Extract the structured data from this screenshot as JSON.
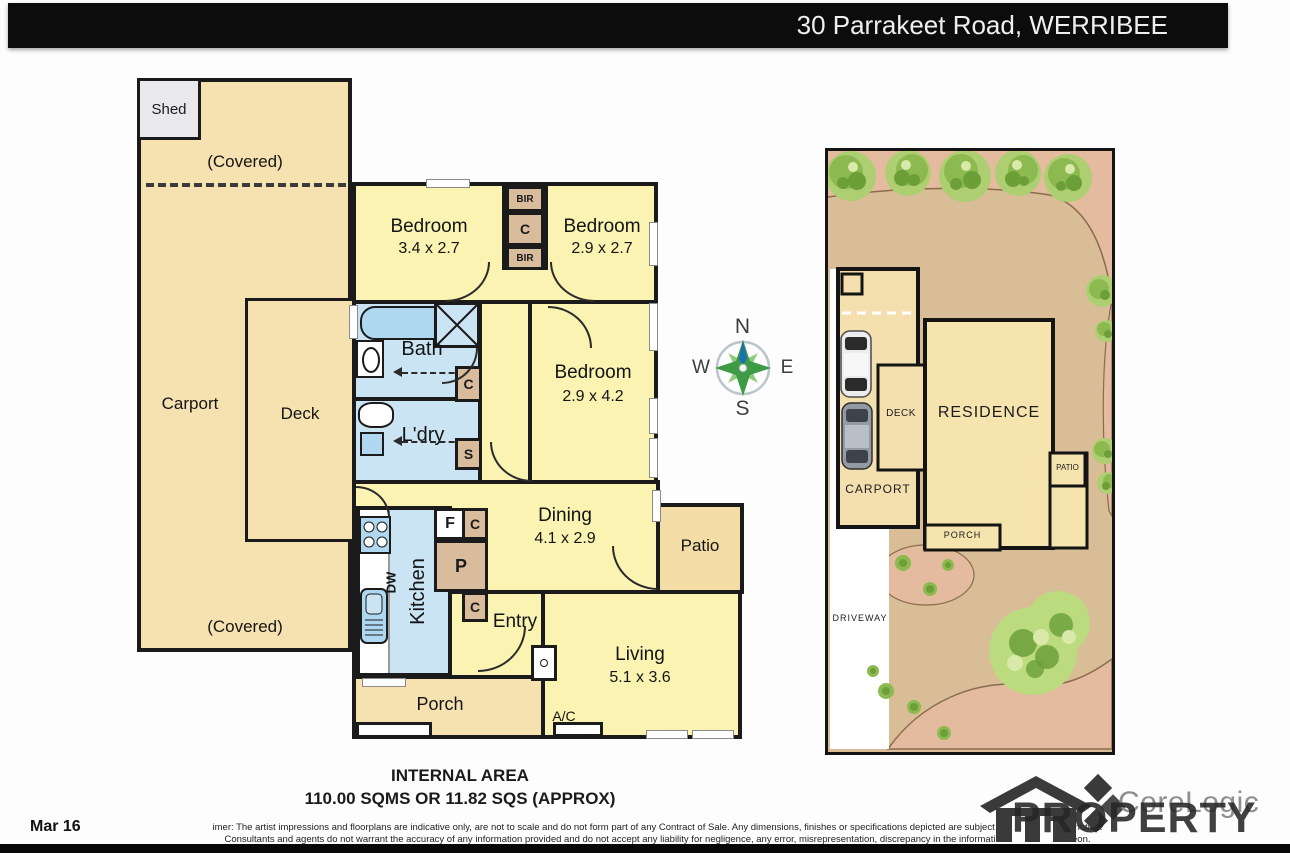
{
  "header": {
    "address": "30 Parrakeet Road, WERRIBEE"
  },
  "labels": {
    "shed": "Shed",
    "covered": "(Covered)",
    "carport": "Carport",
    "deck": "Deck",
    "bedroom": "Bedroom",
    "bath": "Bath",
    "laundry": "L'dry",
    "kitchen": "Kitchen",
    "dw": "DW",
    "dining": "Dining",
    "living": "Living",
    "entry": "Entry",
    "porch": "Porch",
    "patio": "Patio",
    "ac": "A/C",
    "bir": "BIR",
    "c": "C",
    "s": "S",
    "f": "F",
    "p": "P"
  },
  "dims": {
    "bedroom1": "3.4 x 2.7",
    "bedroom2": "2.9 x 2.7",
    "bedroom3": "2.9 x 4.2",
    "dining": "4.1 x 2.9",
    "living": "5.1 x 3.6"
  },
  "compass": {
    "n": "N",
    "s": "S",
    "e": "E",
    "w": "W"
  },
  "siteplan": {
    "residence": "RESIDENCE",
    "carport": "CARPORT",
    "deck": "DECK",
    "porch": "PORCH",
    "patio": "PATIO",
    "driveway": "DRIVEWAY"
  },
  "footer": {
    "internal_area_title": "INTERNAL AREA",
    "internal_area_value": "110.00 SQMS OR 11.82 SQS (APPROX)",
    "date": "Mar 16",
    "disclaimer_line1": "imer: The artist impressions and floorplans are indicative only, are not to scale and do not form part of any Contract of Sale.  Any dimensions, finishes or specifications depicted are subject to change without notice.",
    "disclaimer_line2": "Consultants and agents do not warrant the accuracy of any information provided and do not accept any liability for negligence, any error, misrepresentation, discrepancy in the information or reliance thereon.",
    "logo_text": "CoreLogic",
    "watermark": "PROPERTY"
  },
  "colors": {
    "header_bg": "#0c0c0c",
    "wall": "#1b1b1b",
    "room_yellow": "#FAF3B2",
    "cream": "#F6E2B0",
    "wet_blue": "#CBE4F4",
    "closet_tan": "#D9BC9B",
    "site_ground": "#D8BD96",
    "garden_pink": "#E4BB9E",
    "tree_green": "#8CBA50"
  }
}
